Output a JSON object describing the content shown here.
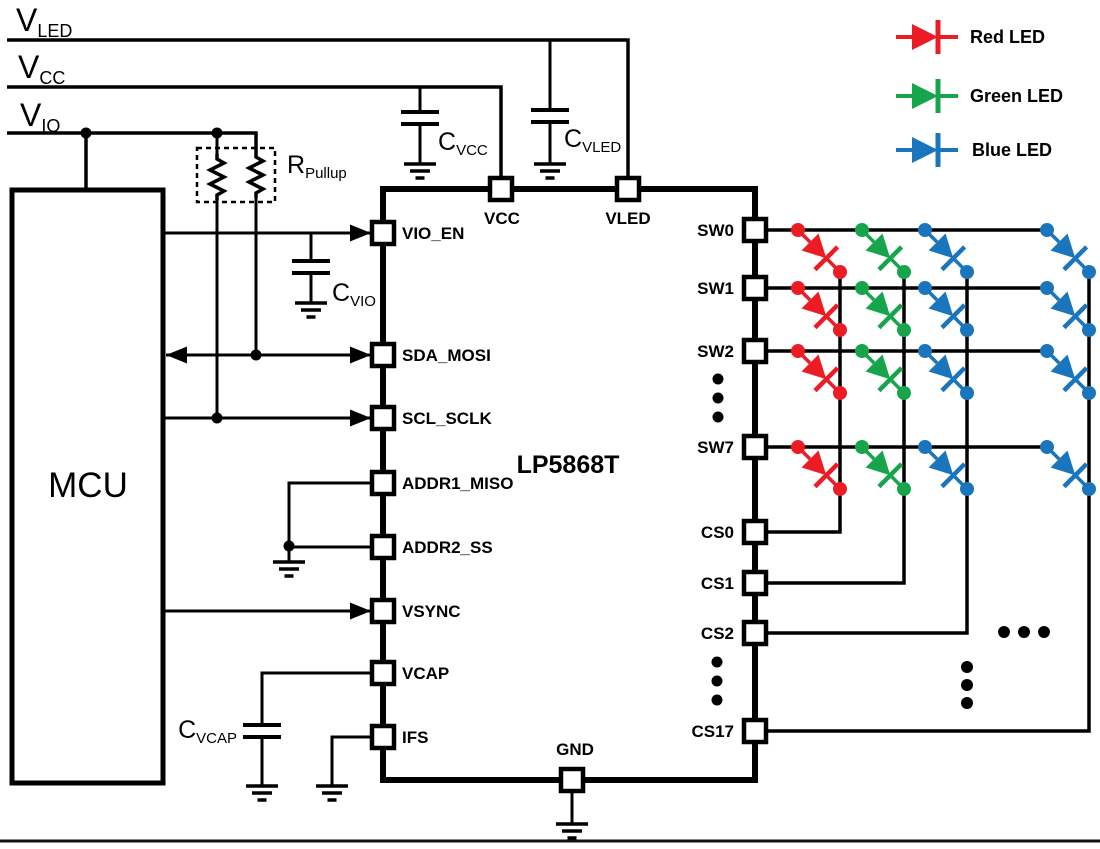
{
  "rails": {
    "vled": {
      "main": "V",
      "sub": "LED"
    },
    "vcc": {
      "main": "V",
      "sub": "CC"
    },
    "vio": {
      "main": "V",
      "sub": "IO"
    }
  },
  "mcu": {
    "label": "MCU"
  },
  "ic": {
    "name": "LP5868T",
    "left_pins": [
      "VIO_EN",
      "SDA_MOSI",
      "SCL_SCLK",
      "ADDR1_MISO",
      "ADDR2_SS",
      "VSYNC",
      "VCAP",
      "IFS"
    ],
    "top_pins": [
      "VCC",
      "VLED"
    ],
    "bottom_pin": "GND",
    "sw_pins": [
      "SW0",
      "SW1",
      "SW2",
      "SW7"
    ],
    "cs_pins": [
      "CS0",
      "CS1",
      "CS2",
      "CS17"
    ]
  },
  "components": {
    "c_vcc": {
      "main": "C",
      "sub": "VCC"
    },
    "c_vled": {
      "main": "C",
      "sub": "VLED"
    },
    "c_vio": {
      "main": "C",
      "sub": "VIO"
    },
    "c_vcap": {
      "main": "C",
      "sub": "VCAP"
    },
    "r_pullup": {
      "main": "R",
      "sub": "Pullup"
    }
  },
  "legend": {
    "items": [
      {
        "label": "Red LED",
        "color": "#EC1C24"
      },
      {
        "label": "Green LED",
        "color": "#17A54C"
      },
      {
        "label": "Blue LED",
        "color": "#1B75BC"
      }
    ]
  },
  "matrix": {
    "rows": [
      "SW0",
      "SW1",
      "SW2",
      "SW7"
    ],
    "columns": [
      {
        "cs": "CS0",
        "color": "#EC1C24",
        "name": "red-led"
      },
      {
        "cs": "CS1",
        "color": "#17A54C",
        "name": "green-led"
      },
      {
        "cs": "CS2",
        "color": "#1B75BC",
        "name": "blue-led"
      },
      {
        "cs": "CS17",
        "color": "#1B75BC",
        "name": "blue-led"
      }
    ]
  },
  "colors": {
    "wire": "#000000",
    "background": "#FFFFFF",
    "red": "#EC1C24",
    "green": "#17A54C",
    "blue": "#1B75BC"
  }
}
